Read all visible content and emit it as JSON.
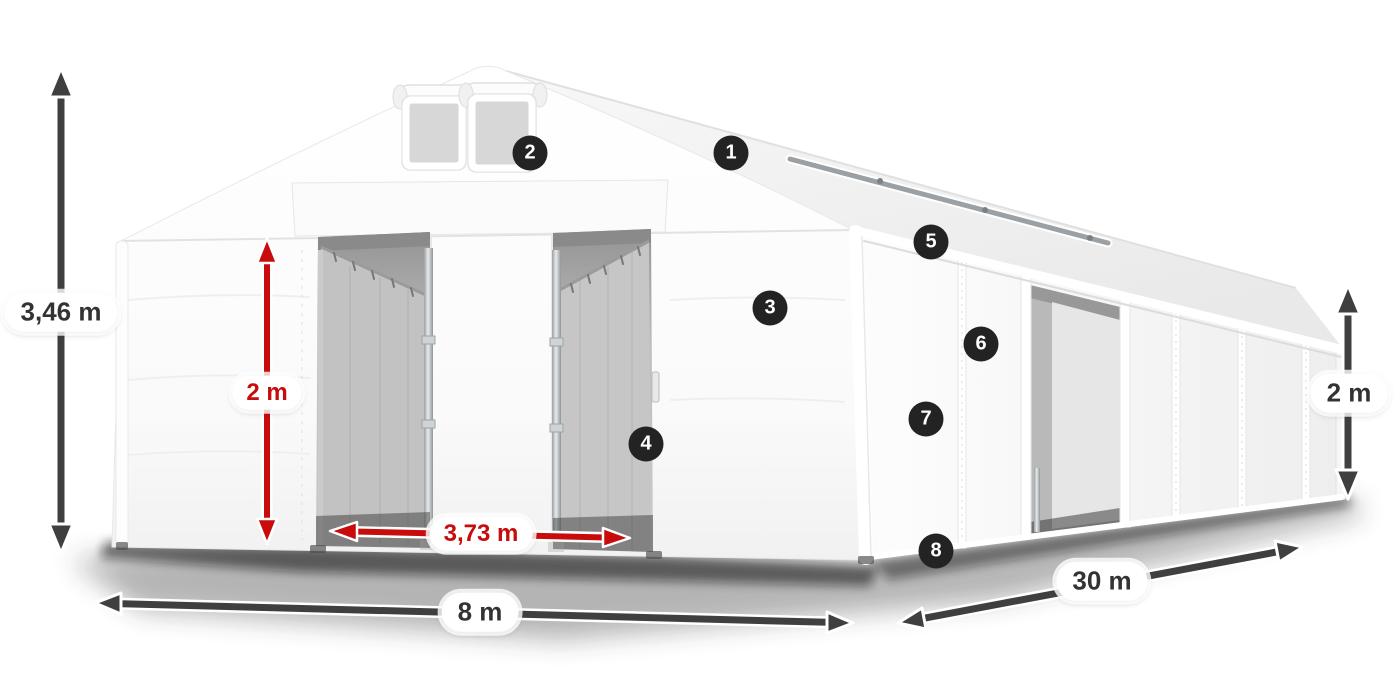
{
  "dimension_labels": {
    "total_height": {
      "text": "3,46 m",
      "style": "dark"
    },
    "entrance_height": {
      "text": "2 m",
      "style": "red"
    },
    "entrance_width": {
      "text": "3,73 m",
      "style": "red"
    },
    "front_width": {
      "text": "8 m",
      "style": "dark"
    },
    "side_length": {
      "text": "30 m",
      "style": "dark"
    },
    "side_wall_height": {
      "text": "2 m",
      "style": "dark"
    }
  },
  "callouts": [
    {
      "number": "1"
    },
    {
      "number": "2"
    },
    {
      "number": "3"
    },
    {
      "number": "4"
    },
    {
      "number": "5"
    },
    {
      "number": "6"
    },
    {
      "number": "7"
    },
    {
      "number": "8"
    }
  ],
  "colors": {
    "background": "#ffffff",
    "tent_white": "#fafafa",
    "interior_gray": "#bdbdbd",
    "arrow_dark": "#3f3f3f",
    "accent_red": "#c80c0c",
    "badge_bg": "#232323",
    "pill_bg": "#ffffff"
  }
}
